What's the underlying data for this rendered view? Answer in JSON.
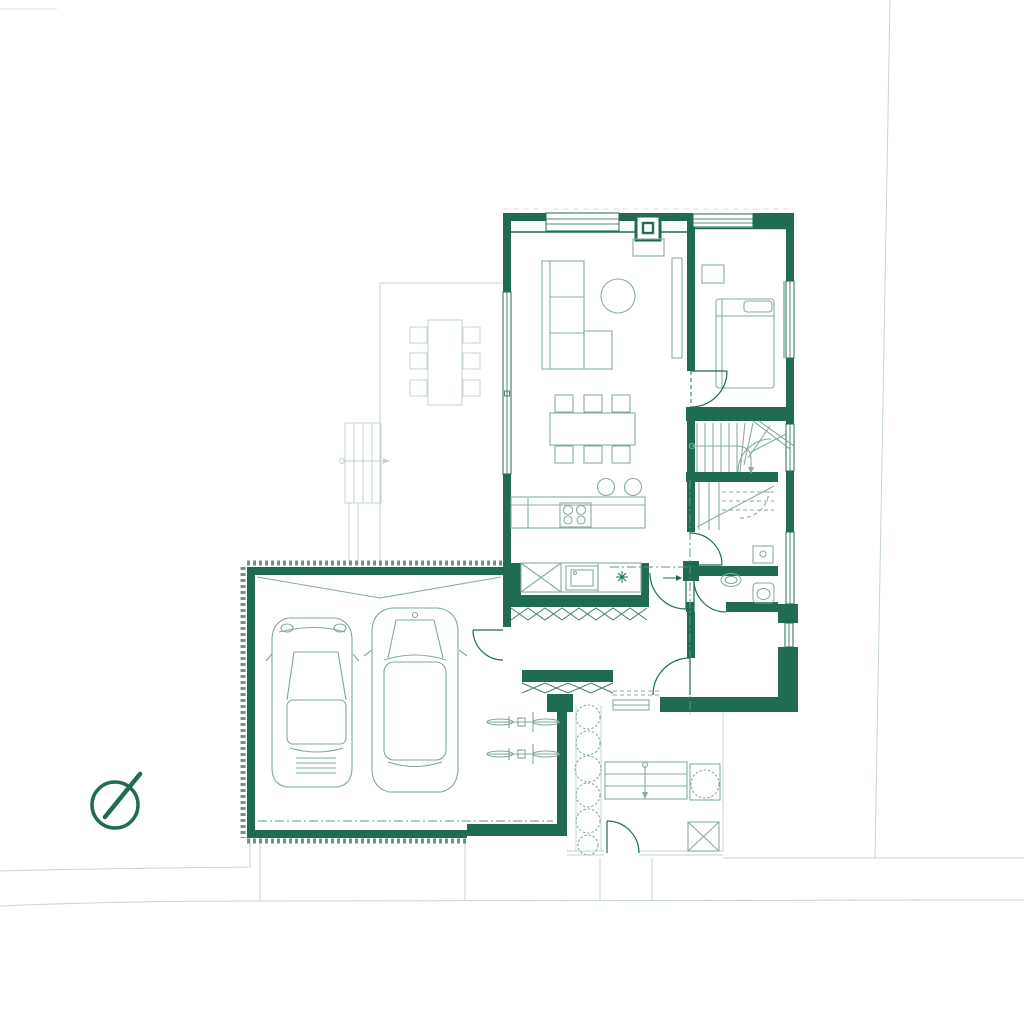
{
  "document": {
    "type": "architectural-floor-plan",
    "description": "Ground-floor plan drawn in green line-work on white: house with living room, kitchen, dining, bedroom, winder stair, WC and hall; double garage with two cars and two bicycles; covered entrance porch, courtyard with shrubs, entry steps, planter tree and gate; terrace with outdoor dining table and garden steps; driveway and site boundary lines; compass rose at lower left.",
    "visible_text": []
  },
  "colors": {
    "bg": "#ffffff",
    "wall": "#1f6b53",
    "wallSoft": "#3f8169",
    "furniture": "#85ad9f",
    "vehicle": "#7fa89a",
    "site": "#c3d6ce",
    "axis": "#5f9480",
    "faint": "#d8e4de"
  },
  "compass": {
    "name": "north-arrow",
    "needle_points": "upper-right"
  },
  "rooms": [
    "living-room",
    "dining-area",
    "kitchen",
    "bedroom",
    "staircase",
    "wc",
    "hall",
    "utility-corridor",
    "entrance-porch",
    "garage",
    "courtyard",
    "terrace",
    "driveway"
  ],
  "features": {
    "cars": 2,
    "bicycles": 2,
    "indoor_dining_chairs": 6,
    "outdoor_dining_chairs": 6,
    "bar_stools": 2,
    "hob_burners": 4,
    "shrubs": 6,
    "planter_trees": 1,
    "door_swings": 8,
    "stair_flights": 2
  }
}
